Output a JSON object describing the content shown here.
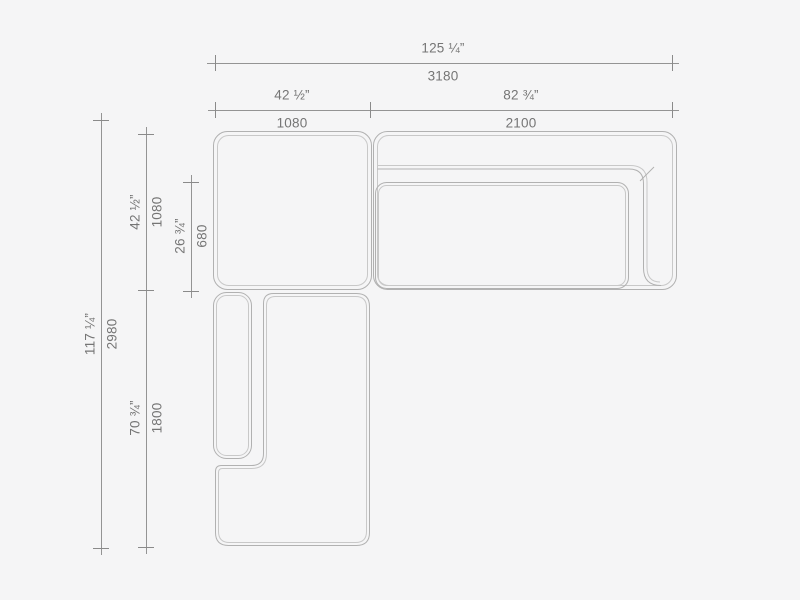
{
  "palette": {
    "background": "#f5f5f6",
    "outline_color": "#b1b1b1",
    "inner_line_color": "#c8c8c8",
    "dimension_line_color": "#8a8a8a",
    "text_color": "#757575"
  },
  "dims": {
    "overall_width": {
      "inches": "125 ¼”",
      "mm": "3180"
    },
    "left_width": {
      "inches": "42 ½”",
      "mm": "1080"
    },
    "right_width": {
      "inches": "82 ¾”",
      "mm": "2100"
    },
    "overall_depth": {
      "inches": "117 ¼”",
      "mm": "2980"
    },
    "corner_depth": {
      "inches": "42 ½”",
      "mm": "1080"
    },
    "seat_depth": {
      "inches": "26 ¾”",
      "mm": "680"
    },
    "chaise_length": {
      "inches": "70 ¾”",
      "mm": "1800"
    }
  }
}
